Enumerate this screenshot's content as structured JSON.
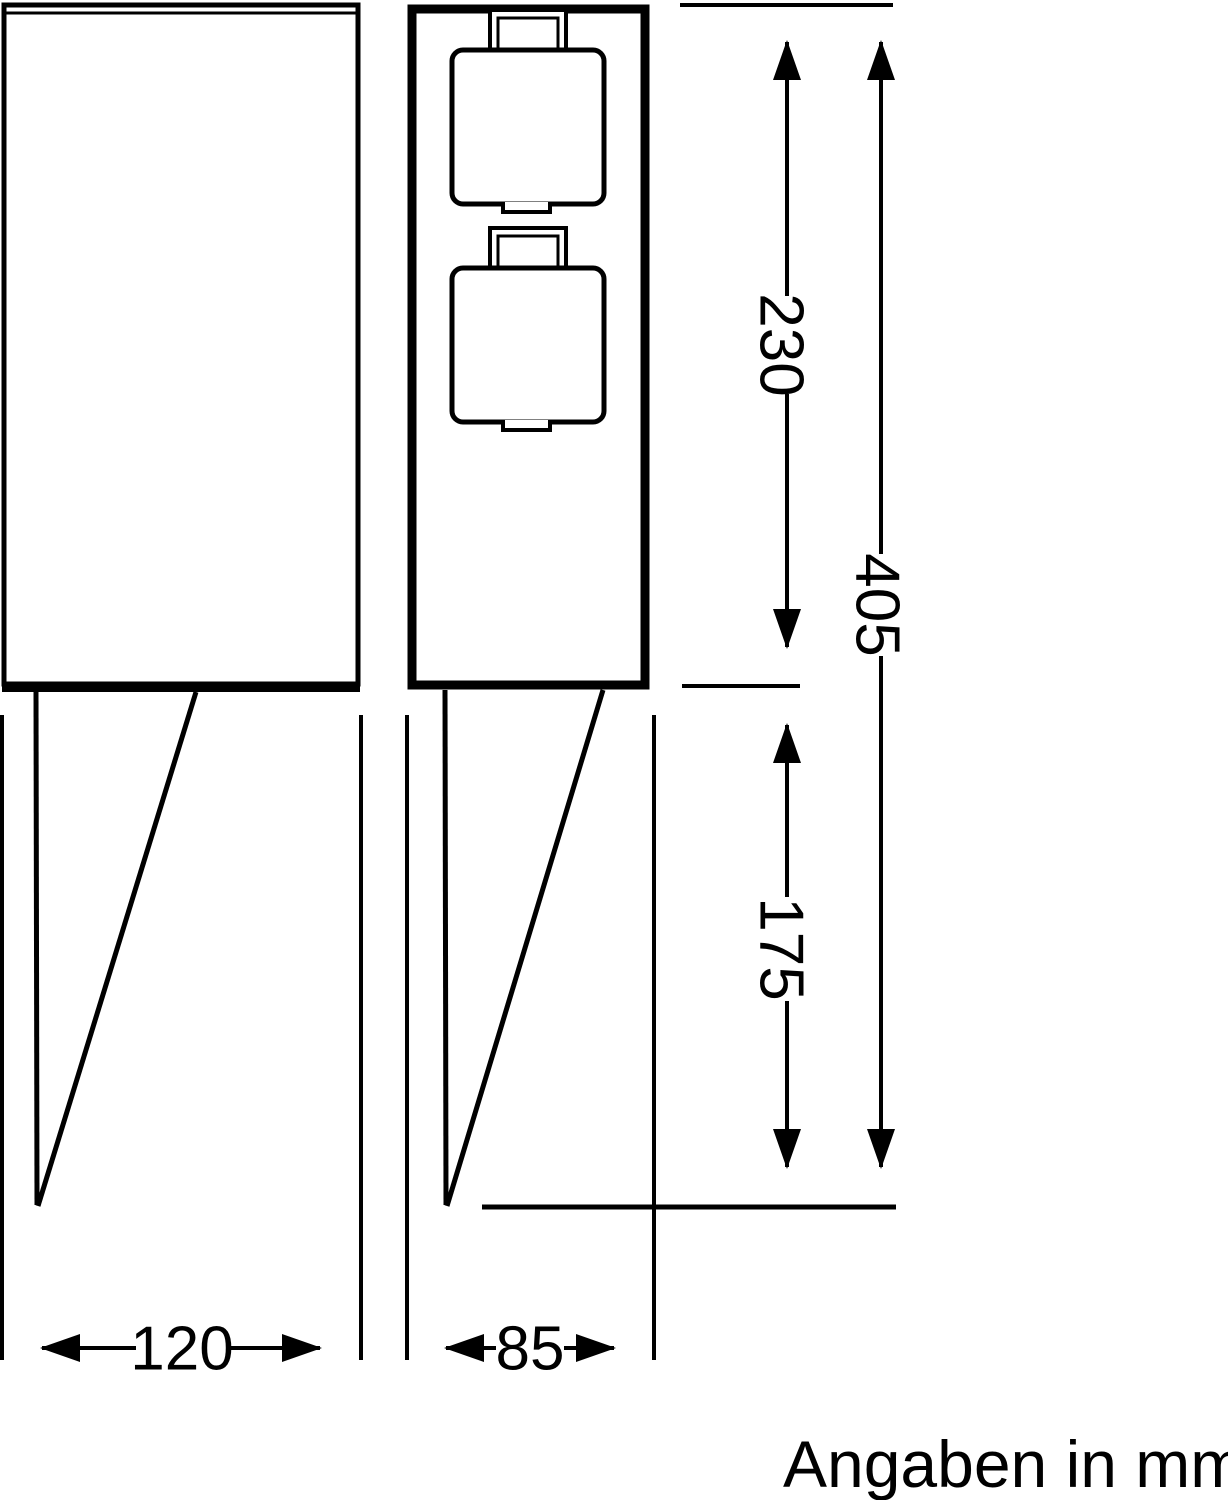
{
  "drawing": {
    "type": "technical-drawing-2-views",
    "units_note": "Angaben in mm",
    "dims": {
      "enclosure_height": "230",
      "total_height": "405",
      "spike_height": "175",
      "front_width": "120",
      "side_width": "85"
    },
    "colors": {
      "ink": "#000000",
      "paper": "#ffffff"
    }
  }
}
